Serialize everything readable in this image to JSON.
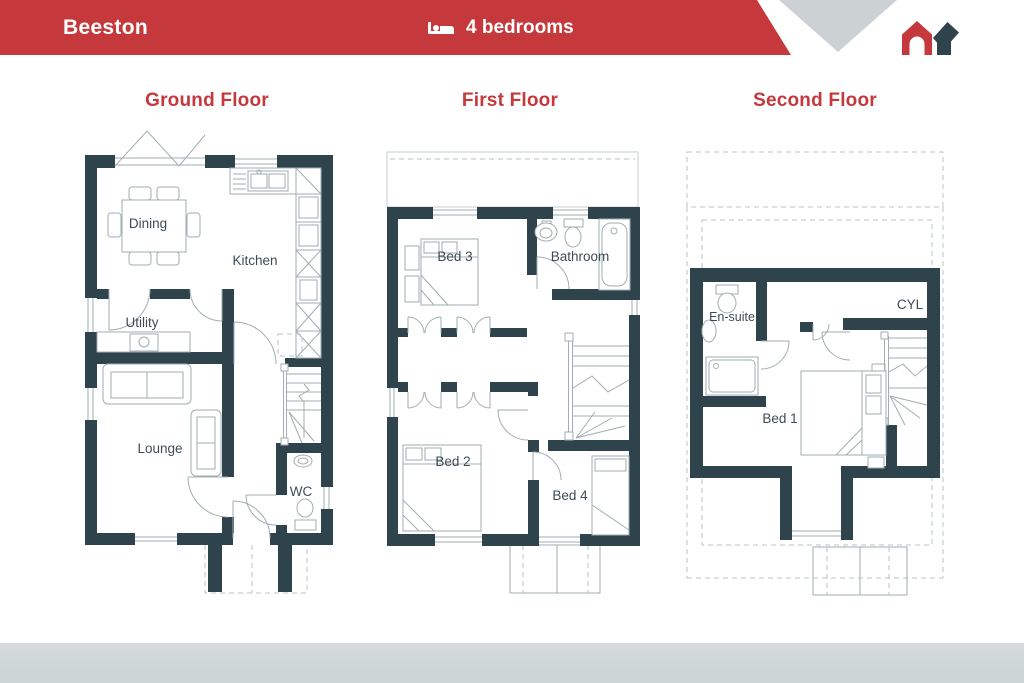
{
  "header": {
    "property_name": "Beeston",
    "bedrooms": "4 bedrooms",
    "bar_color": "#c5393d",
    "chevron_color": "#ccd1d4",
    "icons": {
      "bedrooms": "bed-icon",
      "logo": "house-logo"
    }
  },
  "colors": {
    "accent_red": "#c5393d",
    "wall": "#2e434c",
    "plan_line": "#a2adb2",
    "footer_bar": "#d3dbda"
  },
  "floors": {
    "ground": {
      "title": "Ground Floor",
      "labels": {
        "dining": "Dining",
        "kitchen": "Kitchen",
        "utility": "Utility",
        "lounge": "Lounge",
        "wc": "WC"
      }
    },
    "first": {
      "title": "First Floor",
      "labels": {
        "bed3": "Bed 3",
        "bathroom": "Bathroom",
        "bed2": "Bed 2",
        "bed4": "Bed 4"
      }
    },
    "second": {
      "title": "Second Floor",
      "labels": {
        "ensuite": "En-suite",
        "cyl": "CYL",
        "bed1": "Bed 1"
      }
    }
  }
}
